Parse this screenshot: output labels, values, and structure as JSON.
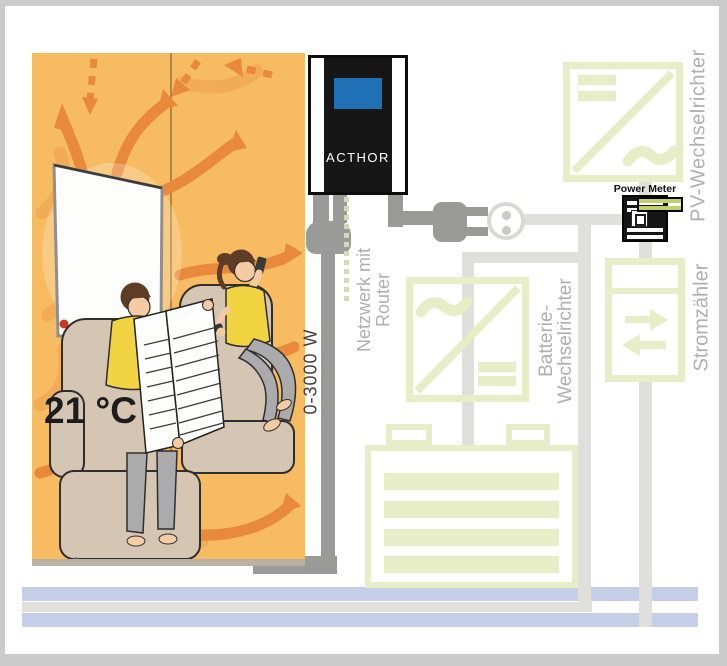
{
  "diagram": {
    "device": {
      "label": "ACTHOR",
      "power_range": "0-3000 W"
    },
    "room": {
      "temperature": "21 °C"
    },
    "network": {
      "line1": "Netzwerk mit",
      "line2": "Router"
    },
    "components": {
      "pv_inverter": "PV-Wechselrichter",
      "power_meter": "Power Meter",
      "grid_meter": "Stromzähler",
      "battery_inverter_line1": "Batterie-",
      "battery_inverter_line2": "Wechselrichter"
    },
    "symbols": {
      "dc": "=",
      "ac": "~"
    },
    "colors": {
      "accent_green": "#e7edc6",
      "room_orange": "#f7bb61",
      "arrow_orange": "#e8893b",
      "wire_light": "#dfdfdc",
      "wire_dark": "#9a9a98",
      "label_gray": "#afafaf",
      "band_blue": "#c4cee9",
      "screen_blue": "#2070b5",
      "device_black": "#161616"
    }
  }
}
